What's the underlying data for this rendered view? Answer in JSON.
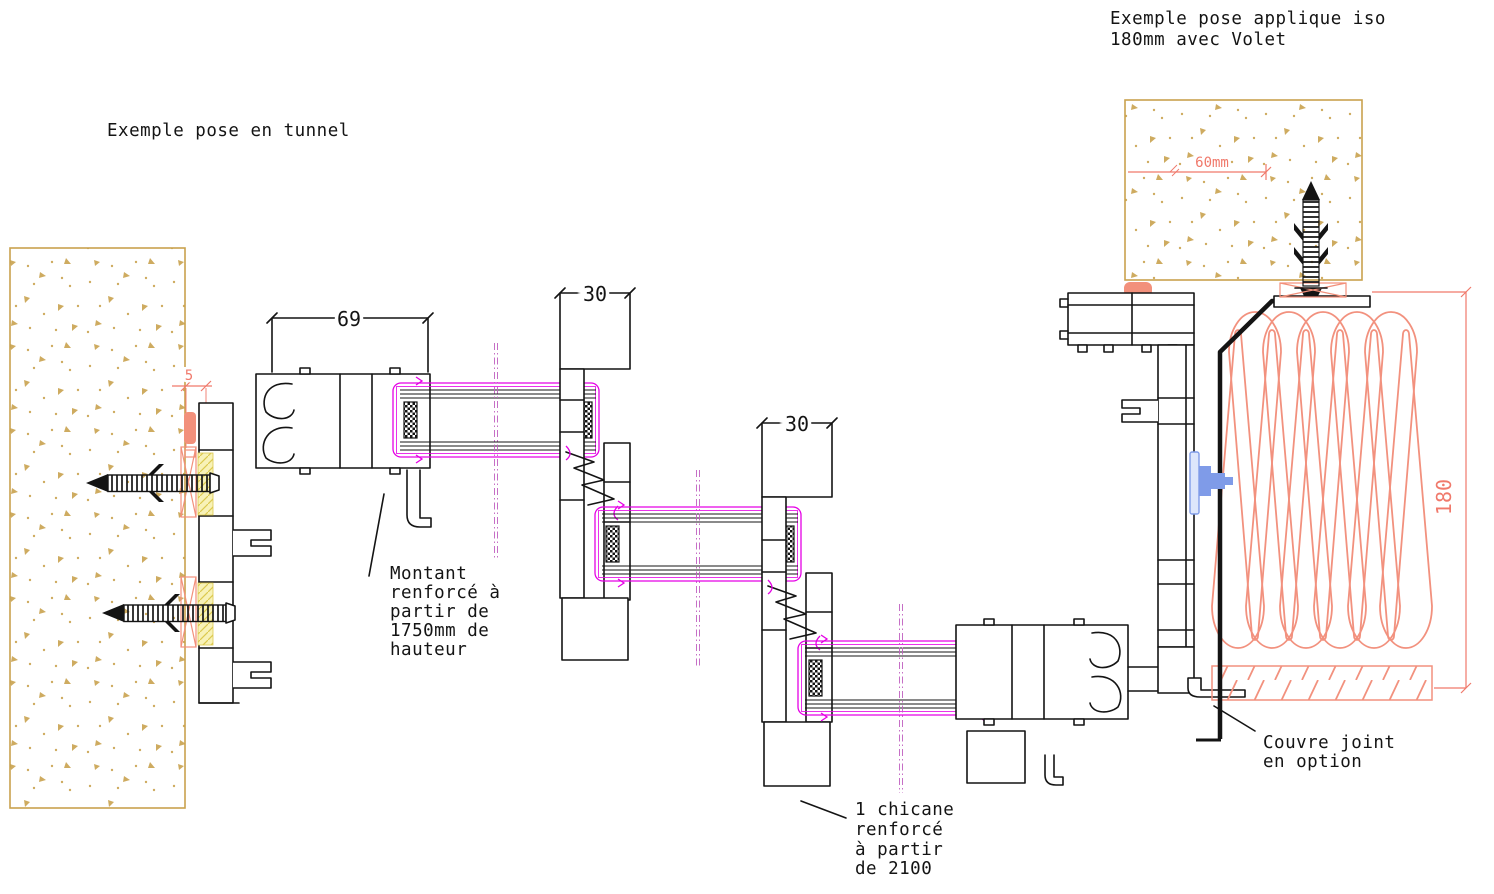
{
  "titles": {
    "left": "Exemple pose en tunnel",
    "right_line1": "Exemple pose applique iso",
    "right_line2": "180mm avec Volet"
  },
  "dimensions": {
    "sash_width": "69",
    "interlock1": "30",
    "interlock2": "30",
    "wall_gap": "5",
    "anchor_depth": "60mm",
    "shutter_height": "180"
  },
  "annotations": {
    "montant": {
      "lines": [
        "Montant",
        "renforcé à",
        "partir de",
        "1750mm de",
        "hauteur"
      ]
    },
    "chicane": {
      "lines": [
        "1 chicane",
        "renforcé",
        "à partir",
        "de 2100"
      ]
    },
    "couvre": {
      "lines": [
        "Couvre joint",
        "en option"
      ]
    }
  },
  "colors": {
    "line": "#141414",
    "wall": "#C9A24E",
    "dim": "#F0796B",
    "seal": "#F2907B",
    "shutter": "#F2917E",
    "gasket": "#E500E5",
    "centerline": "#C060C0",
    "shim": "#DCC94F",
    "shimfill": "#F8F2B8",
    "bolt": "#7F9BE8",
    "boltlight": "#DDE6FB"
  }
}
